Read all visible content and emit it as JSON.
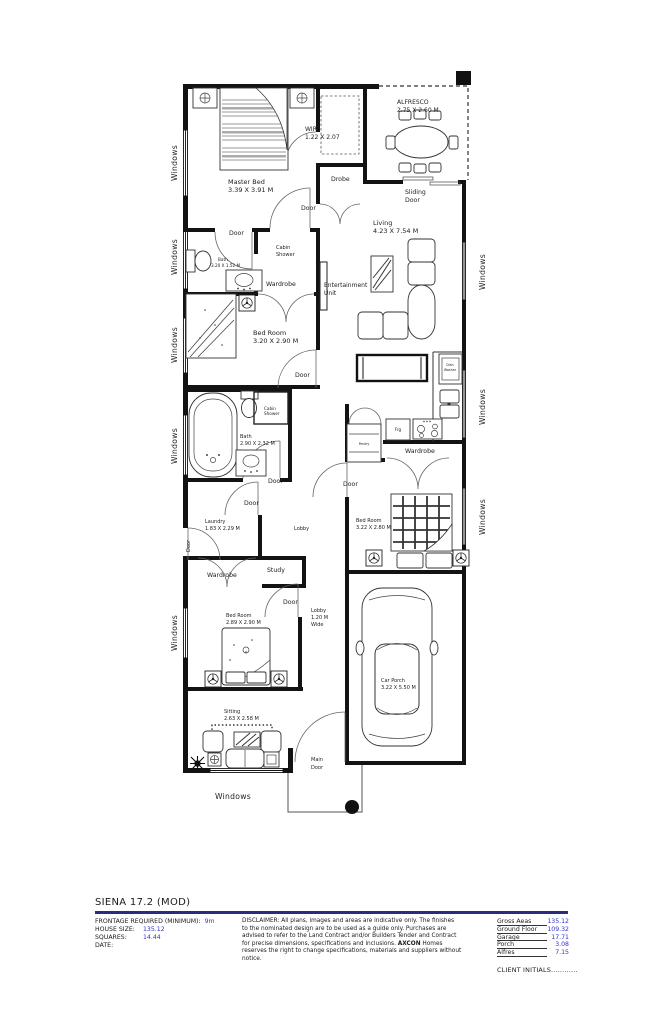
{
  "plan": {
    "rooms": {
      "master_bed": {
        "name": "Master Bed",
        "dim": "3.39 X 3.91 M"
      },
      "wir": {
        "name": "WIR",
        "dim": "1.22 X 2.07"
      },
      "alfresco": {
        "name": "ALFRESCO",
        "dim": "2.75 X 2.60 M"
      },
      "living": {
        "name": "Living",
        "dim": "4.23 X 7.54 M"
      },
      "bath1": {
        "name": "Bath",
        "dim": "3.20 X 1.52 M"
      },
      "bed2": {
        "name": "Bed Room",
        "dim": "3.20 X 2.90 M"
      },
      "bath2": {
        "name": "Bath",
        "dim": "2.90 X 2.32 M"
      },
      "laundry": {
        "name": "Laundry",
        "dim": "1.83 X 2.29 M"
      },
      "bed3": {
        "name": "Bed Room",
        "dim": "2.89 X 2.90 M"
      },
      "bed4": {
        "name": "Bed Room",
        "dim": "3.22 X 2.80 M"
      },
      "car_porch": {
        "name": "Car Porch",
        "dim": "3.22 X 5.50 M"
      },
      "sitting": {
        "name": "Sitting",
        "dim": "2.63 X 2.58 M"
      }
    },
    "labels": {
      "windows": "Windows",
      "door": "Door",
      "drobe": "Drobe",
      "sliding1": "Sliding",
      "sliding2": "Door",
      "cabin1": "Cabin",
      "cabin2": "Shower",
      "wardrobe": "Wardrobe",
      "ent1": "Entertainment",
      "ent2": "Unit",
      "lobby": "Lobby",
      "lobby_w1": "Lobby",
      "lobby_w2": "1.20 M",
      "lobby_w3": "Wide",
      "study": "Study",
      "pantry": "Pantry",
      "frg": "Frg",
      "dish1": "Dish",
      "dish2": "Washer",
      "main1": "Main",
      "main2": "Door"
    }
  },
  "title_block": {
    "title": "SIENA 17.2 (MOD)",
    "frontage_label": "FRONTAGE REQUIRED (MINIMUM):",
    "frontage_value": "9m",
    "house_size_label": "HOUSE SIZE:",
    "house_size_value": "135.12",
    "squares_label": "SQUARES:",
    "squares_value": "14.44",
    "date_label": "DATE:",
    "disclaimer": {
      "l1": "DISCLAIMER: All plans, images and areas are indicative only. The finishes",
      "l2": "to the nominated design are to be used as a guide only. Purchases are",
      "l3": "advised to refer to the Land Contract and/or Builders Tender and Contract",
      "l4a": "for precise dimensions, specifications and inclusions. ",
      "l4b": "AXCON",
      "l4c": " Homes",
      "l5": "reserves the right to change specifications, materials and suppliers without notice."
    },
    "areas": [
      {
        "label": "Gross Aeas",
        "value": "135.12"
      },
      {
        "label": "Ground Floor",
        "value": "109.32"
      },
      {
        "label": "Garage",
        "value": "17.71"
      },
      {
        "label": "Porch",
        "value": "3.08"
      },
      {
        "label": "Alfres",
        "value": "7.15"
      }
    ],
    "client_initials": "CLIENT INITIALS............"
  },
  "colors": {
    "rule_navy": "#2b2b80",
    "value_blue": "#3333cc",
    "ink": "#1a1a1a"
  }
}
